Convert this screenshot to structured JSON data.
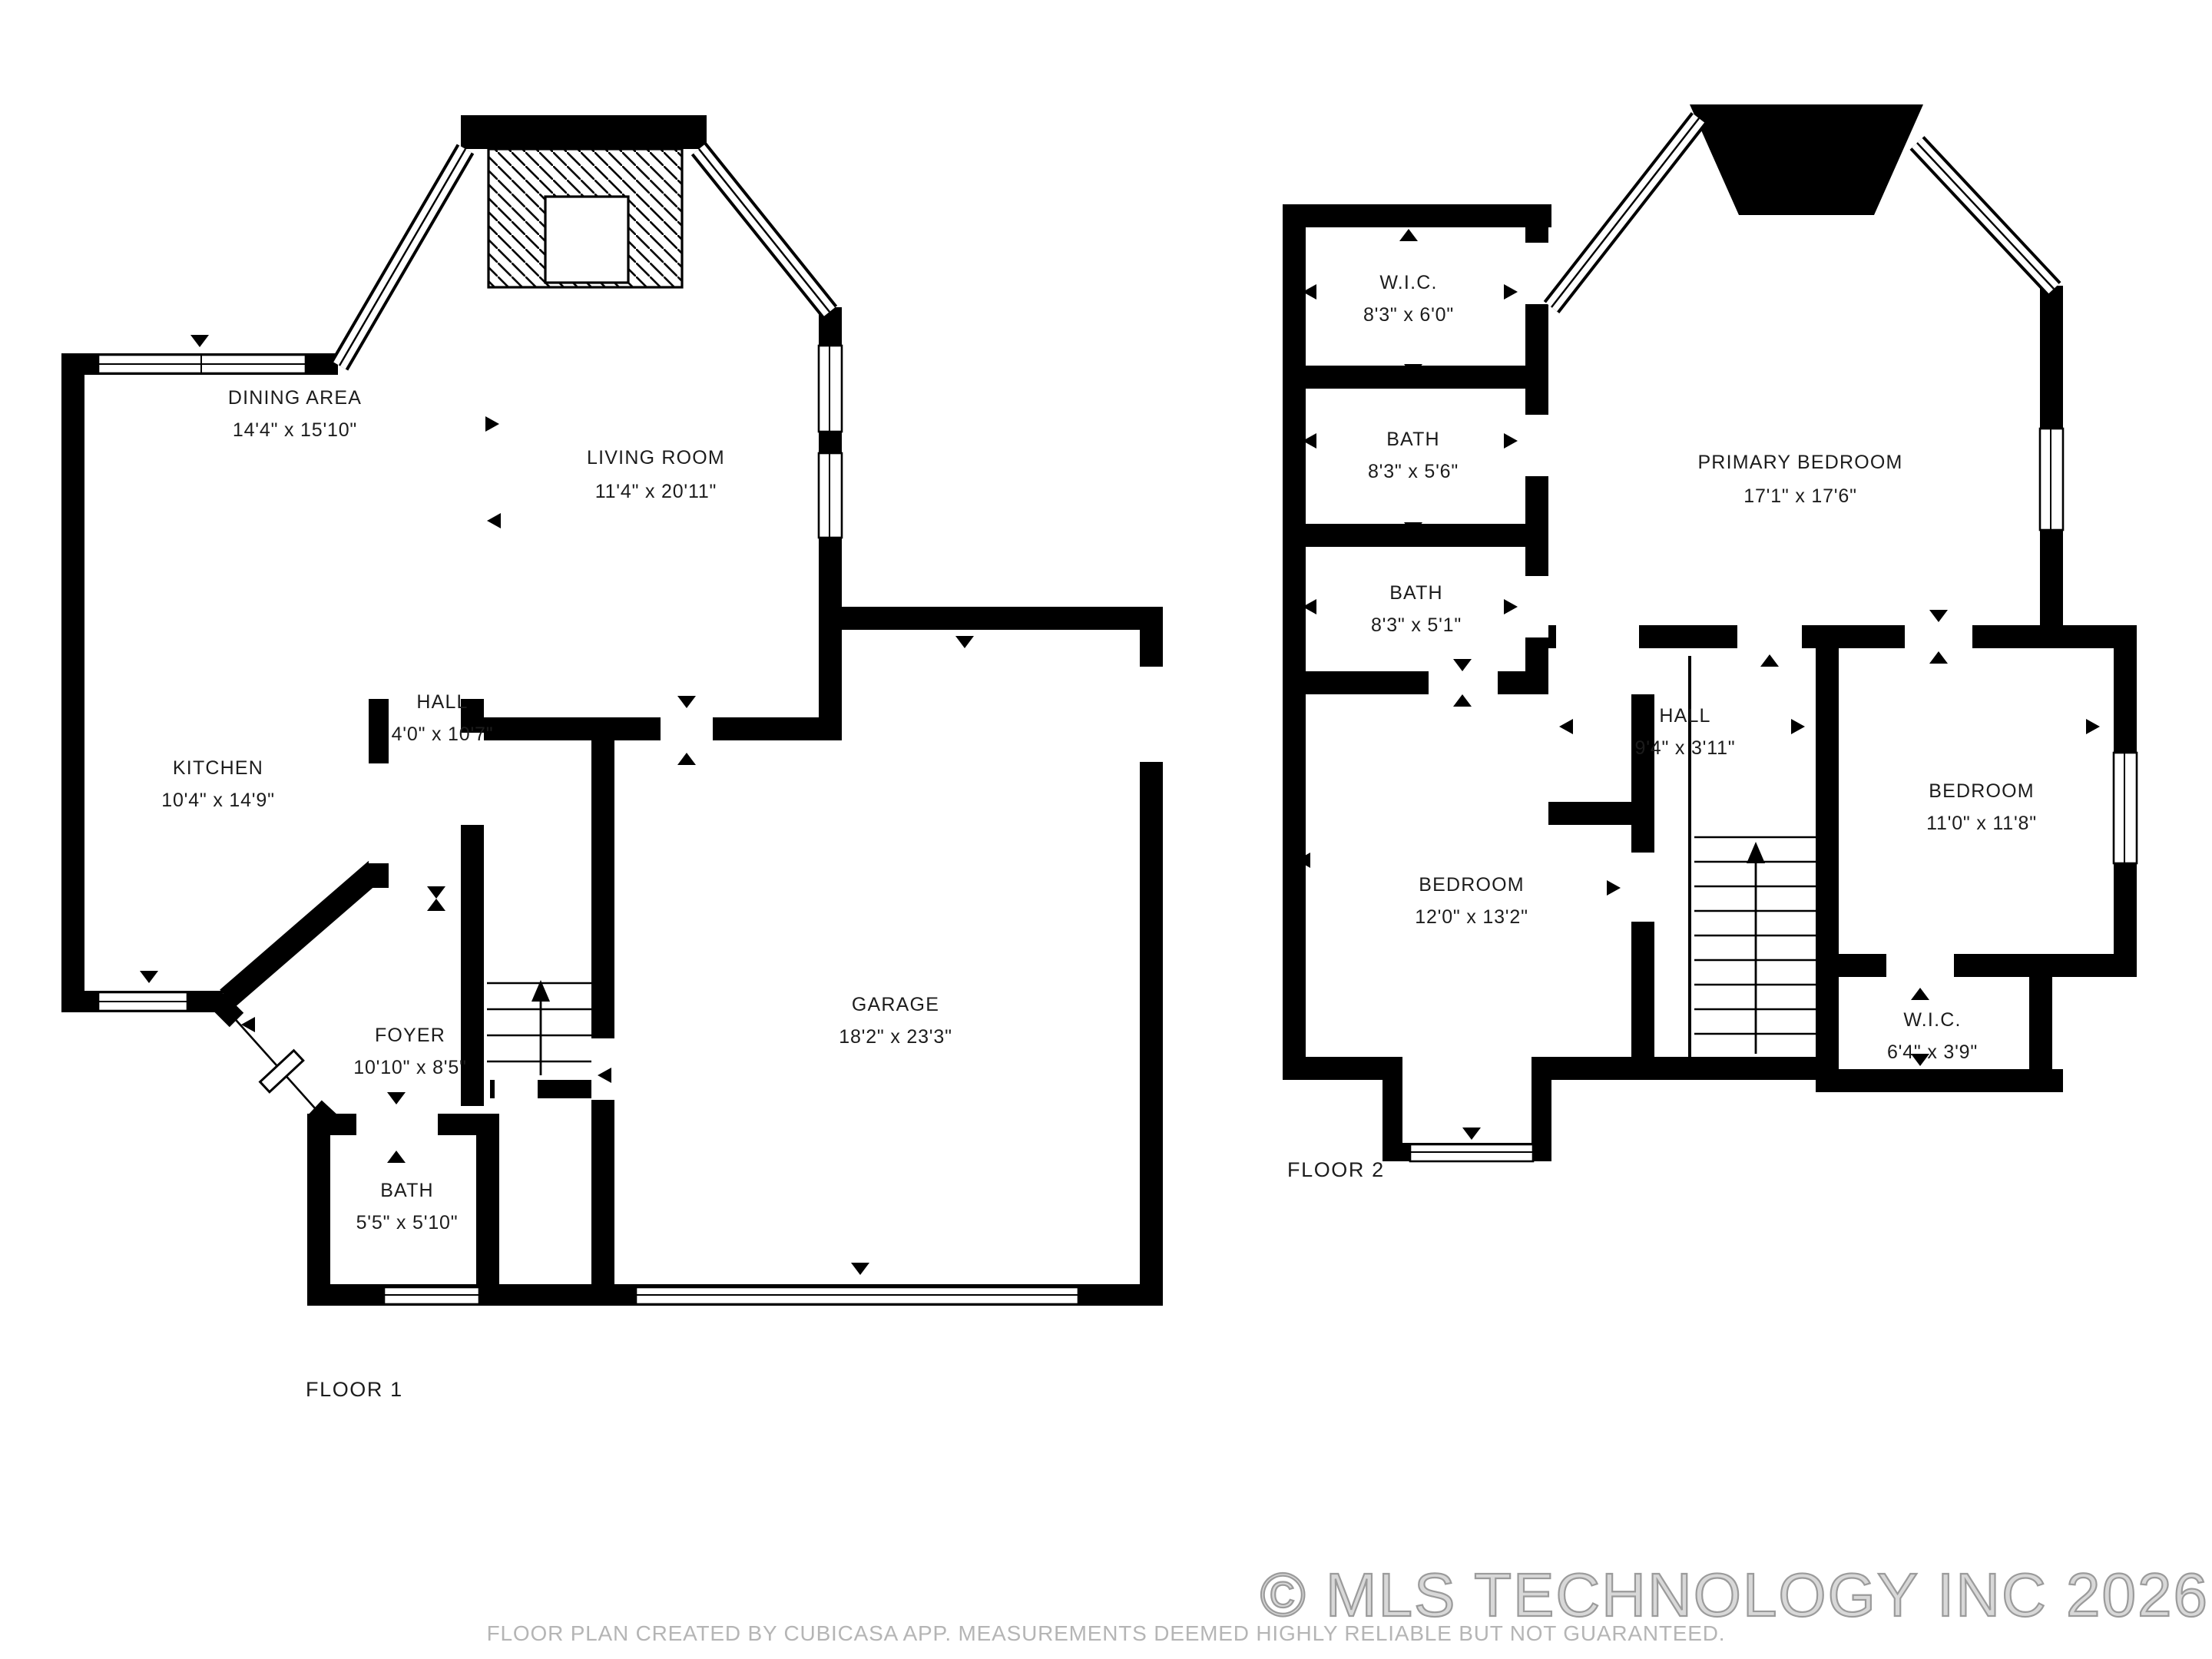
{
  "floor1": {
    "label": "FLOOR 1",
    "rooms": [
      {
        "name": "DINING AREA",
        "dims": "14'4\" x 15'10\""
      },
      {
        "name": "LIVING ROOM",
        "dims": "11'4\" x 20'11\""
      },
      {
        "name": "KITCHEN",
        "dims": "10'4\" x 14'9\""
      },
      {
        "name": "HALL",
        "dims": "4'0\" x 10'7\""
      },
      {
        "name": "FOYER",
        "dims": "10'10\" x 8'5\""
      },
      {
        "name": "GARAGE",
        "dims": "18'2\" x 23'3\""
      },
      {
        "name": "BATH",
        "dims": "5'5\" x 5'10\""
      }
    ]
  },
  "floor2": {
    "label": "FLOOR 2",
    "rooms": [
      {
        "name": "W.I.C.",
        "dims": "8'3\" x 6'0\""
      },
      {
        "name": "BATH",
        "dims": "8'3\" x 5'6\""
      },
      {
        "name": "BATH",
        "dims": "8'3\" x 5'1\""
      },
      {
        "name": "PRIMARY BEDROOM",
        "dims": "17'1\" x 17'6\""
      },
      {
        "name": "HALL",
        "dims": "9'4\" x 3'11\""
      },
      {
        "name": "BEDROOM",
        "dims": "12'0\" x 13'2\""
      },
      {
        "name": "BEDROOM",
        "dims": "11'0\" x 11'8\""
      },
      {
        "name": "W.I.C.",
        "dims": "6'4\" x 3'9\""
      }
    ]
  },
  "footer": {
    "disclaimer": "FLOOR PLAN CREATED BY CUBICASA APP. MEASUREMENTS DEEMED HIGHLY RELIABLE BUT NOT GUARANTEED.",
    "copyright": "© MLS TECHNOLOGY INC 2026"
  },
  "colors": {
    "wall": "#000000",
    "watermark_light": "#d8d8d8",
    "watermark_dark": "#9b9b9b"
  }
}
